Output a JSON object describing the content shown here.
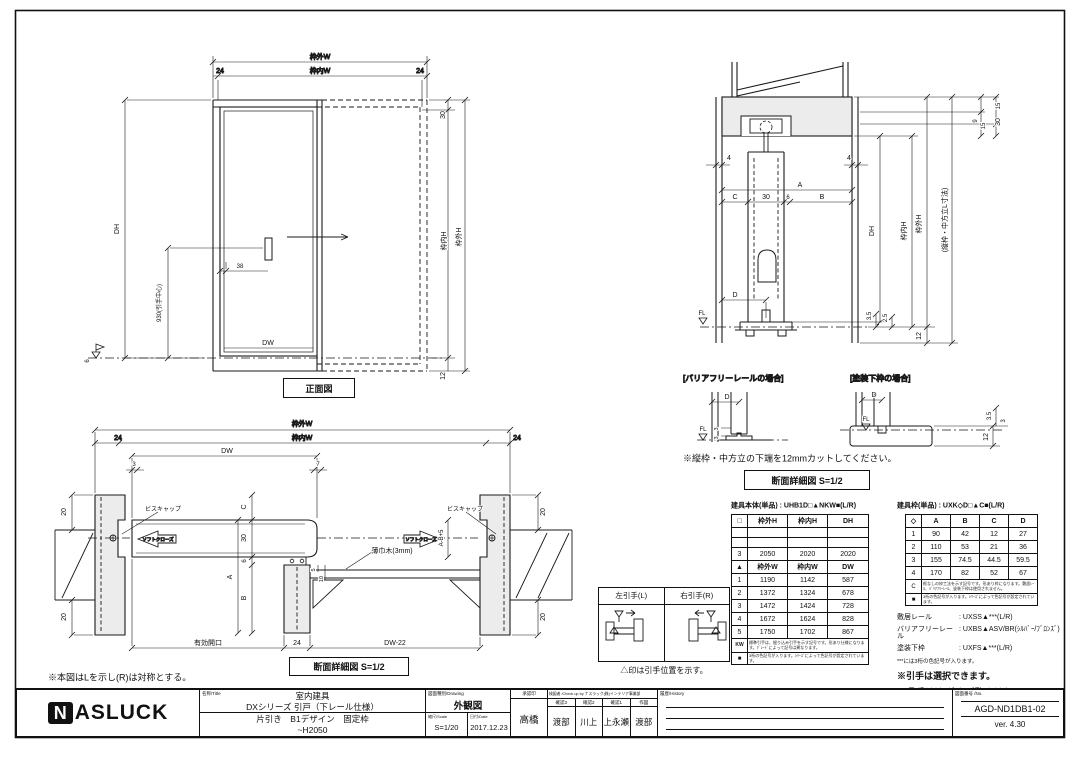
{
  "front_view": {
    "title": "正面図",
    "dim_wakugai_w": "枠外W",
    "dim_left24": "24",
    "dim_wakunai_w": "枠内W",
    "dim_right24": "24",
    "dim_dh": "DH",
    "dim_handle_center": "930(引手中心)",
    "dim_36": "38",
    "dim_6": "6",
    "dim_30": "30",
    "dim_wakunai_h": "枠内H",
    "dim_wakugai_h": "枠外H",
    "dim_12": "12",
    "dim_dw": "DW"
  },
  "plan_view": {
    "title": "断面詳細図 S=1/2",
    "note": "※本図はLを示し(R)は対称とする。",
    "dim_wakugai_w": "枠外W",
    "dim_left24": "24",
    "dim_wakunai_w": "枠内W",
    "dim_right24": "24",
    "dim_dw": "DW",
    "dim_3": "3",
    "dim_7": "7",
    "dim_20_tl": "20",
    "dim_20_bl": "20",
    "dim_20_tr": "20",
    "dim_20_br": "20",
    "label_biscap_l": "ビスキャップ",
    "label_biscap_r": "ビスキャップ",
    "label_softclose_l": "ソフトクローズ",
    "label_softclose_r": "ソフトクローズ",
    "dim_c": "C",
    "dim_30": "30",
    "dim_6": "6",
    "dim_a": "A",
    "dim_b": "B",
    "dim_5": "5",
    "dim_10": "10",
    "label_usubaki": "薄巾木(3mm)",
    "dim_abp5": "A-B+5",
    "dim_koukou": "有効開口",
    "dim_24": "24",
    "dim_dw22": "DW-22"
  },
  "section_view": {
    "title": "断面詳細図 S=1/2",
    "note": "※縦枠・中方立の下端を12mmカットしてください。",
    "case_left": "[バリアフリーレールの場合]",
    "case_right": "[塗装下枠の場合]",
    "dim_4l": "4",
    "dim_4r": "4",
    "dim_a": "A",
    "dim_c": "C",
    "dim_30": "30",
    "dim_6": "6",
    "dim_b": "B",
    "dim_d": "D",
    "label_fl": "FL",
    "dim_9": "9",
    "dim_15a": "15",
    "dim_15b": "15",
    "dim_30r": "30",
    "dim_dh": "DH",
    "dim_wakunai_h": "枠内H",
    "dim_wakugai_h": "枠外H",
    "dim_tatewaku": "(縦枠・中方立L寸法)",
    "dim_35": "3.5",
    "dim_25": "2.5",
    "dim_12": "12",
    "det_l_d": "D",
    "det_l_fl": "FL",
    "det_l_3a": "3",
    "det_l_3b": "3",
    "det_r_d": "D",
    "det_r_fl": "FL",
    "det_r_35": "3.5",
    "det_r_3": "3",
    "det_r_12": "12"
  },
  "handle_selector": {
    "left_label": "左引手(L)",
    "right_label": "右引手(R)",
    "note": "△印は引手位置を示す。"
  },
  "body_table": {
    "title": "建具本体(単品) : UHB1D□▲NKW■(L/R)",
    "h_header": [
      "□",
      "枠外H",
      "枠内H",
      "DH"
    ],
    "h_rows": [
      [
        "",
        "",
        "",
        ""
      ],
      [
        "",
        "",
        "",
        ""
      ],
      [
        "3",
        "2050",
        "2020",
        "2020"
      ]
    ],
    "w_header": [
      "▲",
      "枠外W",
      "枠内W",
      "DW"
    ],
    "w_rows": [
      [
        "1",
        "1190",
        "1142",
        "587"
      ],
      [
        "2",
        "1372",
        "1324",
        "678"
      ],
      [
        "3",
        "1472",
        "1424",
        "728"
      ],
      [
        "4",
        "1672",
        "1624",
        "828"
      ],
      [
        "5",
        "1750",
        "1702",
        "867"
      ]
    ],
    "kw_key": "KW",
    "kw_note": "標準引手は、掘り込み引手を示す記号です。形あり仕様になります。ｸﾞﾚｰﾄﾞによって記号は異なります。",
    "sq_key": "■",
    "sq_note": "3桁の色記号が入ります。ｼﾘｰｽﾞによって色記号が設定されています。"
  },
  "frame_table": {
    "title": "建具枠(単品) : UXK◇D□▲C■(L/R)",
    "header": [
      "◇",
      "A",
      "B",
      "C",
      "D"
    ],
    "rows": [
      [
        "1",
        "90",
        "42",
        "12",
        "27"
      ],
      [
        "2",
        "110",
        "53",
        "21",
        "36"
      ],
      [
        "3",
        "155",
        "74.5",
        "44.5",
        "59.5"
      ],
      [
        "4",
        "170",
        "82",
        "52",
        "67"
      ]
    ],
    "c_key": "C",
    "c_note": "框なしの枠工法を示す記号です。形あり枠になります。敷居ﾚｰﾙ、ﾊﾞﾘｱﾌﾘｰﾚｰﾙ、塗装下枠は使用されません。",
    "sq_key": "■",
    "sq_note": "3桁の色記号が入ります。ｼﾘｰｽﾞによって色記号が設定されています。"
  },
  "rail_info": {
    "rows": [
      {
        "label": "敷居レール",
        "value": ": UXSS▲***(L/R)"
      },
      {
        "label": "バリアフリーレール",
        "value": ": UXBS▲ASV/BR(ｼﾙﾊﾞｰ/ﾌﾞﾛﾝｽﾞ)"
      },
      {
        "label": "塗装下枠",
        "value": ": UXFS▲***(L/R)"
      }
    ],
    "note_small": "***には3桁の色記号が入ります。",
    "note1": "※引手は選択できます。",
    "note2": "品番はｶﾀﾛｸﾞをご覧ください。"
  },
  "title_block": {
    "logo_n": "N",
    "logo_rest": "ASLUCK",
    "name_header": "名称/Title",
    "name_line1": "室内建具",
    "name_line2": "DXシリーズ 引戸（下レール仕様）",
    "name_line3": "片引き　B1デザイン　固定枠",
    "name_line4": "~H2050",
    "drawing_header": "図面種別/Drawing",
    "drawing_value": "外観図",
    "scale_header": "縮尺/Scale",
    "scale_value": "S=1/20",
    "date_header": "日付/Date",
    "date_value": "2017.12.23",
    "approval_header": "承認印",
    "approval_value": "高橋",
    "check_header": "検図者 /Check up by ナスラック(株)インテリア事業部",
    "check_cols": [
      {
        "h": "確認3",
        "v": "渡部"
      },
      {
        "h": "確認2",
        "v": "川上"
      },
      {
        "h": "確認1",
        "v": "上永瀬"
      },
      {
        "h": "作図",
        "v": "渡部"
      }
    ],
    "history_header": "履歴/History",
    "no_header": "図面番号 /No.",
    "no_value": "AGD-ND1DB1-02",
    "version": "ver. 4.30"
  }
}
